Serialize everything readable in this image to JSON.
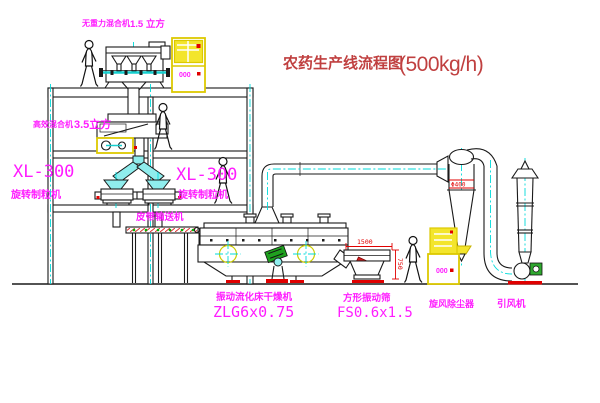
{
  "title": {
    "name": "农药生产线流程图",
    "capacity": "(500kg/h)"
  },
  "equipment_labels": {
    "gravity_mixer": {
      "name": "无重力混合机",
      "size": "1.5 立方"
    },
    "efficiency_mixer": {
      "name": "高效混合机",
      "size": "3.5立方"
    },
    "granulator_left": {
      "model": "XL-300",
      "name": "旋转制粒机"
    },
    "granulator_center": {
      "model": "XL-300",
      "name": "旋转制粒机"
    },
    "belt_conveyor": {
      "name": "皮带输送机"
    },
    "dryer": {
      "name": "振动流化床干燥机",
      "model": "ZLG6x0.75"
    },
    "sieve": {
      "name": "方形振动筛",
      "model": "FS0.6x1.5"
    },
    "cyclone": {
      "name": "旋风除尘器"
    },
    "fan": {
      "name": "引风机"
    }
  },
  "dimensions": {
    "sieve_width": "1500",
    "sieve_height": "750",
    "cyclone_note": "Φ400"
  },
  "cabinets": {
    "top_display": "000",
    "right_display": "000"
  },
  "colors": {
    "label": "#ff1cff",
    "title": "#c04040",
    "dimension": "#e00000",
    "centerline": "#00dbdb",
    "cabinet": "#f3e52c",
    "chute": "#8feded",
    "motor": "#2fa82f",
    "base_pad": "#e00000"
  }
}
